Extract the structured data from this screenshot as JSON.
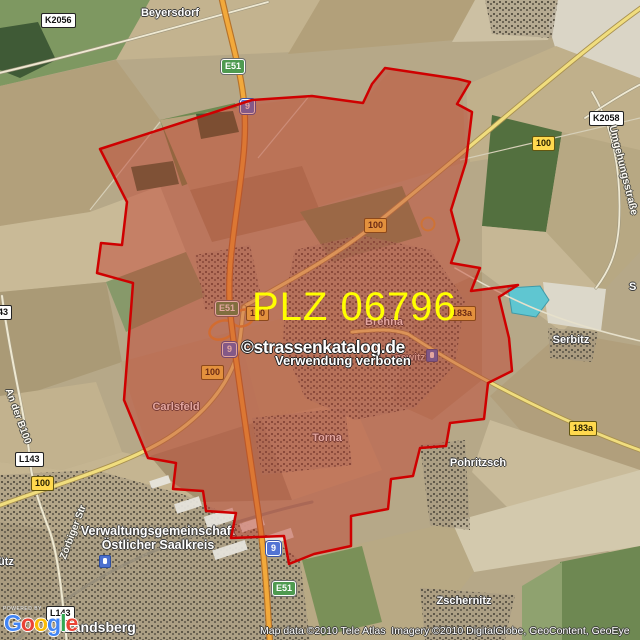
{
  "overlay": {
    "plz_label": "PLZ 06796",
    "plz_color": "#ffff00",
    "boundary_color": "#cf0000",
    "fill_color": "#c03a2b"
  },
  "watermark": {
    "copyright": "©strassenkatalog.de",
    "notice": "Verwendung verboten"
  },
  "attribution": {
    "text": "Map data ©2010 Tele Atlas  Imagery ©2010 DigitalGlobe, GeoContent, GeoEye"
  },
  "branding": {
    "powered_by": "POWERED BY",
    "letters": [
      {
        "ch": "G",
        "style": "color:#4285F4"
      },
      {
        "ch": "o",
        "style": "color:#EA4335"
      },
      {
        "ch": "o",
        "style": "color:#FBBC05"
      },
      {
        "ch": "g",
        "style": "color:#4285F4"
      },
      {
        "ch": "l",
        "style": "color:#34A853"
      },
      {
        "ch": "e",
        "style": "color:#EA4335"
      }
    ]
  },
  "road_shields": [
    {
      "label": "K2056",
      "type": "minor-road"
    },
    {
      "label": "E51",
      "type": "euro-route"
    },
    {
      "label": "9",
      "type": "autobahn"
    },
    {
      "label": "K2058",
      "type": "minor-road"
    },
    {
      "label": "100",
      "type": "bundesstrasse"
    },
    {
      "label": "100",
      "type": "bundesstrasse"
    },
    {
      "label": "E51",
      "type": "euro-route"
    },
    {
      "label": "100",
      "type": "bundesstrasse"
    },
    {
      "label": "9",
      "type": "autobahn"
    },
    {
      "label": "100",
      "type": "bundesstrasse"
    },
    {
      "label": "183a",
      "type": "bundesstrasse"
    },
    {
      "label": "183a",
      "type": "bundesstrasse"
    },
    {
      "label": "L143",
      "type": "minor-road"
    },
    {
      "label": "100",
      "type": "bundesstrasse"
    },
    {
      "label": "L143",
      "type": "minor-road"
    },
    {
      "label": "43",
      "type": "minor-road-partial"
    },
    {
      "label": "9",
      "type": "autobahn"
    },
    {
      "label": "E51",
      "type": "euro-route"
    }
  ],
  "place_labels": [
    {
      "name": "Beyersdorf"
    },
    {
      "name": "Brehna"
    },
    {
      "name": "Serbitz"
    },
    {
      "name": "Carlsfeld"
    },
    {
      "name": "Torna"
    },
    {
      "name": "Pohritzsch"
    },
    {
      "name": "Zschernitz"
    },
    {
      "name": "Landsberg"
    },
    {
      "name": "newitz"
    },
    {
      "name": "ütz"
    },
    {
      "name": "S"
    }
  ],
  "admin_labels": {
    "line1": "Verwaltungsgemeinschaft",
    "line2": "Östlicher Saalkreis"
  },
  "street_labels": [
    {
      "name": "Umgehungsstraße"
    },
    {
      "name": "An der B100"
    },
    {
      "name": "Zörbiger Str"
    }
  ],
  "icons": [
    {
      "name": "station-icon"
    },
    {
      "name": "station-icon"
    }
  ],
  "colors": {
    "autobahn_shield": "#5374d4",
    "bundesstrasse_shield": "#ffd94e",
    "euro_route_shield": "#4e9a50",
    "minor_road_shield": "#ffffff",
    "water": "#5fc6d1",
    "highway_road": "#f2a93b",
    "overlay_fill": "#c03a2b",
    "overlay_stroke": "#cf0000",
    "plz_text": "#ffff00"
  }
}
